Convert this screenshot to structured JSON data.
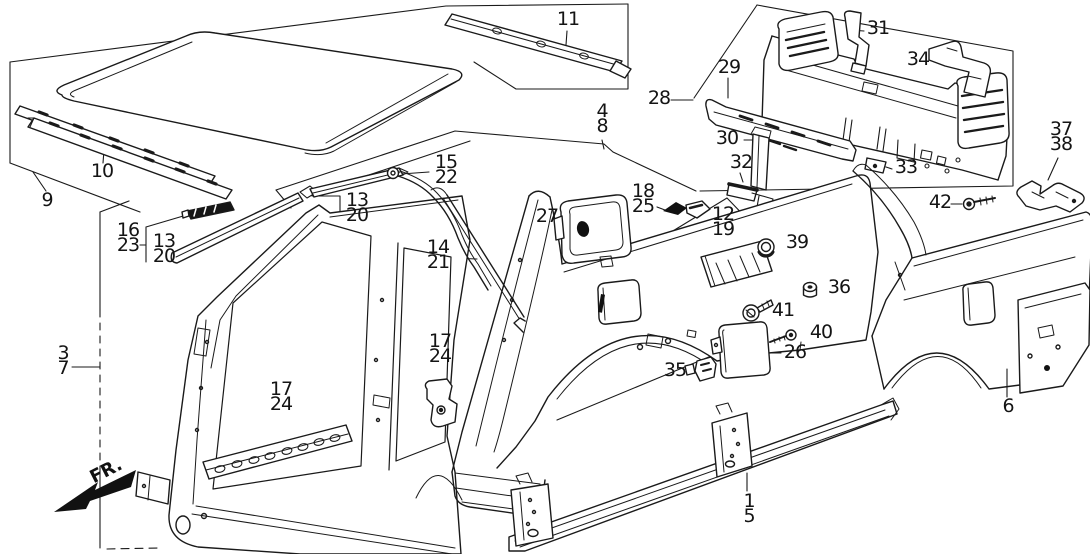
{
  "diagram": {
    "fr_label": "FR.",
    "callouts": [
      {
        "id": "9",
        "lines": [
          "9"
        ]
      },
      {
        "id": "10",
        "lines": [
          "10"
        ]
      },
      {
        "id": "11",
        "lines": [
          "11"
        ]
      },
      {
        "id": "4-8",
        "lines": [
          "4",
          "8"
        ]
      },
      {
        "id": "28",
        "lines": [
          "28"
        ]
      },
      {
        "id": "29",
        "lines": [
          "29"
        ]
      },
      {
        "id": "31",
        "lines": [
          "31"
        ]
      },
      {
        "id": "34",
        "lines": [
          "34"
        ]
      },
      {
        "id": "30",
        "lines": [
          "30"
        ]
      },
      {
        "id": "32",
        "lines": [
          "32"
        ]
      },
      {
        "id": "33",
        "lines": [
          "33"
        ]
      },
      {
        "id": "37-38",
        "lines": [
          "37",
          "38"
        ]
      },
      {
        "id": "42",
        "lines": [
          "42"
        ]
      },
      {
        "id": "15-22",
        "lines": [
          "15",
          "22"
        ]
      },
      {
        "id": "13-20-right",
        "lines": [
          "13",
          "20"
        ]
      },
      {
        "id": "16-23",
        "lines": [
          "16",
          "23"
        ]
      },
      {
        "id": "13-20-left",
        "lines": [
          "13",
          "20"
        ]
      },
      {
        "id": "14-21",
        "lines": [
          "14",
          "21"
        ]
      },
      {
        "id": "27",
        "lines": [
          "27"
        ]
      },
      {
        "id": "18-25",
        "lines": [
          "18",
          "25"
        ]
      },
      {
        "id": "12-19",
        "lines": [
          "12",
          "19"
        ]
      },
      {
        "id": "39",
        "lines": [
          "39"
        ]
      },
      {
        "id": "36",
        "lines": [
          "36"
        ]
      },
      {
        "id": "41",
        "lines": [
          "41"
        ]
      },
      {
        "id": "40",
        "lines": [
          "40"
        ]
      },
      {
        "id": "26",
        "lines": [
          "26"
        ]
      },
      {
        "id": "35",
        "lines": [
          "35"
        ]
      },
      {
        "id": "3-7",
        "lines": [
          "3",
          "7"
        ]
      },
      {
        "id": "17-24-door",
        "lines": [
          "17",
          "24"
        ]
      },
      {
        "id": "17-24-bracket",
        "lines": [
          "17",
          "24"
        ]
      },
      {
        "id": "1-5",
        "lines": [
          "1",
          "5"
        ]
      },
      {
        "id": "6",
        "lines": [
          "6"
        ]
      }
    ]
  }
}
